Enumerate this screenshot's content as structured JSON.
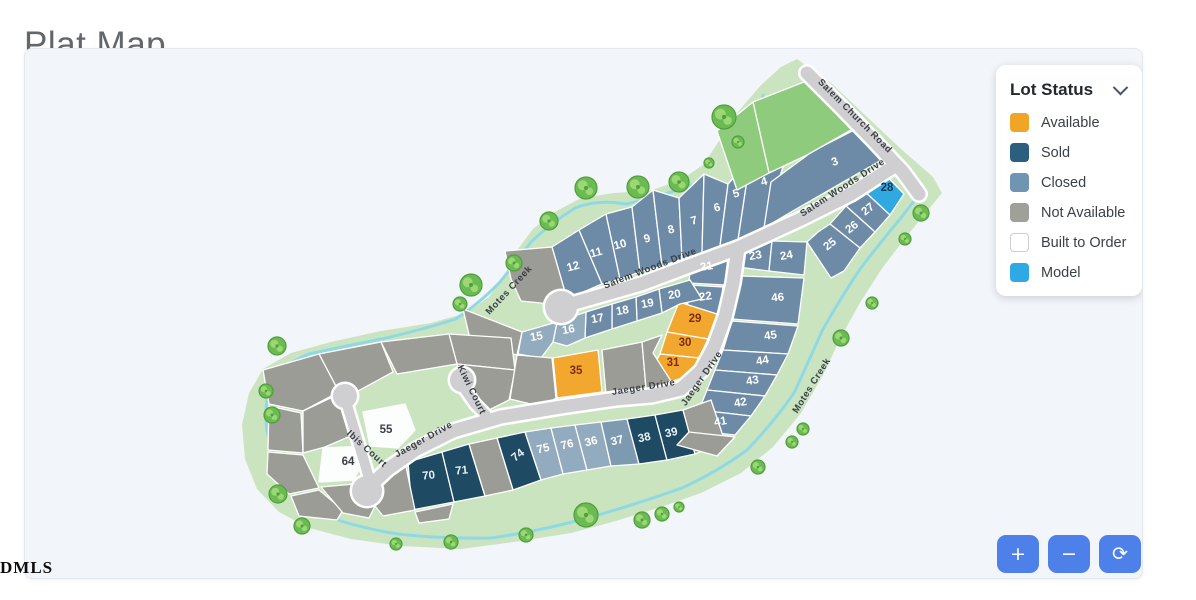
{
  "title": "Plat Map",
  "watermark": "DMLS",
  "legend": {
    "title": "Lot Status",
    "chevron_icon": "chevron-down-icon",
    "items": [
      {
        "label": "Available",
        "color": "#F0A527",
        "border": false
      },
      {
        "label": "Sold",
        "color": "#2C5F7D",
        "border": false
      },
      {
        "label": "Closed",
        "color": "#7095B3",
        "border": false
      },
      {
        "label": "Not Available",
        "color": "#9FA099",
        "border": false
      },
      {
        "label": "Built to Order",
        "color": "#FFFFFF",
        "border": true
      },
      {
        "label": "Model",
        "color": "#2FA9E4",
        "border": false
      }
    ]
  },
  "controls": [
    {
      "name": "zoom-in-button",
      "icon": "plus-icon",
      "glyph": "+"
    },
    {
      "name": "zoom-out-button",
      "icon": "minus-icon",
      "glyph": "−"
    },
    {
      "name": "reset-view-button",
      "icon": "refresh-icon",
      "glyph": "⟳"
    }
  ],
  "map": {
    "colors": {
      "buffer": "#CBE4C0",
      "creek": "#8FD9E4",
      "road": "#CFCFD1",
      "available": "#F2A72E",
      "sold": "#1E4A63",
      "closed": "#6D8BA6",
      "closed_light": "#93ABBE",
      "closed_med": "#7E9AB0",
      "na": "#9C9C96",
      "bto": "#FCFDFD",
      "model": "#2FA9E0",
      "green": "#8FCB7C",
      "tree": "#6ABB51",
      "tree_edge": "#519E3C",
      "tree_light": "#9BD774"
    },
    "text_colors": {
      "available": "#7E2D12",
      "sold": "#E8F1F7",
      "closed": "#FFFFFF",
      "closed_light": "#FFFFFF",
      "closed_med": "#FFFFFF",
      "bto": "#3A3F45",
      "model": "#16375A"
    },
    "buffer_path": "M796,58 L830,82 L864,114 L900,148 L932,176 L941,192 L928,208 L905,236 L882,266 L860,300 L840,336 L822,374 L800,412 L772,446 L740,472 L700,492 L660,506 L615,520 L570,532 L520,540 L460,548 L400,545 L350,538 L308,527 L278,511 L256,488 L244,458 L241,424 L248,392 L262,368 L290,352 L330,341 L380,330 L430,322 L465,312 L488,296 L505,272 L517,248 L532,228 L552,212 L578,198 L612,192 L648,190 L678,180 L702,164 L718,140 L736,112 L760,84 L780,66 Z",
    "creek_path": "M762,94 Q754,140 741,190 Q720,184 690,184 Q658,196 625,203 Q596,198 574,207 Q550,222 530,241 Q514,262 499,281 Q480,301 455,318 Q420,329 385,337 Q345,345 308,353 Q282,363 269,383 Q263,405 266,430 Q272,456 286,479 Q302,500 325,515 Q358,527 397,533 Q440,538 490,537 Q540,530 590,516 Q636,503 681,487 Q716,471 746,449 Q773,421 793,392 Q807,362 821,330 Q839,298 859,268 Q879,242 899,218 L913,200",
    "roads": [
      {
        "id": "salem-church-road",
        "d": "M806,72 L840,106 L872,139 L902,171 L918,193",
        "w": 13
      },
      {
        "id": "salem-woods-drive",
        "d": "M892,166 L850,193 L800,218 L737,247 L688,265 L640,283 L598,295 L570,303",
        "w": 13
      },
      {
        "id": "jaeger-drive",
        "d": "M737,247 L732,282 L724,316 L713,346 L700,370 L680,388 L650,395 L615,398 L560,406 L500,416 L452,430 L414,449 L387,468 L372,482",
        "w": 13
      },
      {
        "id": "ibis-court",
        "d": "M346,404 L355,434 L363,460 L368,477",
        "w": 10
      },
      {
        "id": "kiwi-court",
        "d": "M463,387 L474,403 L485,414",
        "w": 10
      }
    ],
    "culdesacs": [
      {
        "x": 560,
        "y": 306,
        "r": 16
      },
      {
        "x": 366,
        "y": 490,
        "r": 15
      },
      {
        "x": 344,
        "y": 395,
        "r": 12
      },
      {
        "x": 461,
        "y": 379,
        "r": 12
      }
    ],
    "road_labels": [
      {
        "text": "Salem Church Road",
        "x": 852,
        "y": 117,
        "rot": 45
      },
      {
        "text": "Salem Woods Drive",
        "x": 843,
        "y": 189,
        "rot": -33
      },
      {
        "text": "Salem Woods Drive",
        "x": 650,
        "y": 270,
        "rot": -21
      },
      {
        "text": "Jaeger Drive",
        "x": 703,
        "y": 379,
        "rot": -55
      },
      {
        "text": "Jaeger Drive",
        "x": 643,
        "y": 389,
        "rot": -9
      },
      {
        "text": "Jaeger Drive",
        "x": 424,
        "y": 441,
        "rot": -29
      },
      {
        "text": "Ibis Court",
        "x": 364,
        "y": 450,
        "rot": 42
      },
      {
        "text": "Kiwi Court",
        "x": 468,
        "y": 390,
        "rot": 64
      },
      {
        "text": "Motes Creek",
        "x": 510,
        "y": 291,
        "rot": -47
      },
      {
        "text": "Motes Creek",
        "x": 813,
        "y": 386,
        "rot": -58
      }
    ],
    "trees": [
      [
        585,
        187,
        11
      ],
      [
        637,
        186,
        11
      ],
      [
        678,
        181,
        10
      ],
      [
        723,
        116,
        12
      ],
      [
        737,
        141,
        6
      ],
      [
        708,
        162,
        5
      ],
      [
        548,
        220,
        9
      ],
      [
        513,
        262,
        8
      ],
      [
        470,
        284,
        11
      ],
      [
        459,
        303,
        7
      ],
      [
        276,
        345,
        9
      ],
      [
        265,
        390,
        7
      ],
      [
        271,
        414,
        8
      ],
      [
        277,
        493,
        9
      ],
      [
        301,
        525,
        8
      ],
      [
        585,
        514,
        12
      ],
      [
        641,
        519,
        8
      ],
      [
        661,
        513,
        7
      ],
      [
        678,
        506,
        5
      ],
      [
        525,
        534,
        7
      ],
      [
        450,
        541,
        7
      ],
      [
        395,
        543,
        6
      ],
      [
        920,
        212,
        8
      ],
      [
        904,
        238,
        6
      ],
      [
        871,
        302,
        6
      ],
      [
        840,
        337,
        8
      ],
      [
        802,
        428,
        6
      ],
      [
        791,
        441,
        6
      ],
      [
        757,
        466,
        7
      ]
    ],
    "lots": [
      {
        "n": "12",
        "s": "closed",
        "p": "551,246 578,229 601,283 566,298",
        "t": [
          573,
          269
        ],
        "r": -15
      },
      {
        "n": "11",
        "s": "closed",
        "p": "578,229 605,213 619,278 601,283",
        "t": [
          596,
          255
        ],
        "r": -15
      },
      {
        "n": "10",
        "s": "closed",
        "p": "605,213 631,206 639,271 619,278",
        "t": [
          620,
          247
        ],
        "r": -15
      },
      {
        "n": "9",
        "s": "closed",
        "p": "631,206 652,189 661,265 639,271",
        "t": [
          647,
          241
        ],
        "r": -15
      },
      {
        "n": "8",
        "s": "closed",
        "p": "652,189 678,197 681,258 661,265",
        "t": [
          671,
          232
        ],
        "r": -15
      },
      {
        "n": "7",
        "s": "closed",
        "p": "678,197 703,173 701,252 681,258",
        "t": [
          694,
          223
        ],
        "r": -15
      },
      {
        "n": "6",
        "s": "closed",
        "p": "703,173 727,183 719,245 701,252",
        "t": [
          717,
          210
        ],
        "r": -15
      },
      {
        "n": "5",
        "s": "closed",
        "p": "727,183 749,159 737,239 719,245",
        "t": [
          736,
          196
        ],
        "r": -15
      },
      {
        "n": "4",
        "s": "closed",
        "p": "749,159 789,143 763,227 737,239",
        "t": [
          764,
          184
        ],
        "r": -15
      },
      {
        "n": "3",
        "s": "closed",
        "p": "763,227 790,211 884,157 857,127 812,150 770,181",
        "t": [
          835,
          164
        ],
        "r": -20
      },
      {
        "n": "",
        "s": "green",
        "p": "808,79 857,125 806,154 768,172 752,101"
      },
      {
        "n": "",
        "s": "green",
        "p": "752,101 768,172 736,189 716,130"
      },
      {
        "n": "28",
        "s": "model",
        "p": "876,165 903,193 889,214 861,188",
        "t": [
          886,
          190
        ]
      },
      {
        "n": "27",
        "s": "closed",
        "p": "861,188 889,214 874,231 845,205",
        "t": [
          869,
          211
        ],
        "r": -38
      },
      {
        "n": "26",
        "s": "closed",
        "p": "845,205 874,231 859,247 829,223",
        "t": [
          853,
          229
        ],
        "r": -38
      },
      {
        "n": "25",
        "s": "closed",
        "p": "829,223 859,247 843,270 830,277 806,241 817,231",
        "t": [
          831,
          246
        ],
        "r": -38
      },
      {
        "n": "21",
        "s": "closed",
        "p": "690,256 728,246 724,284 688,282",
        "t": [
          706,
          269
        ],
        "r": -8
      },
      {
        "n": "22",
        "s": "closed",
        "p": "688,284 722,286 718,314 686,312",
        "t": [
          705,
          299
        ],
        "r": -8
      },
      {
        "n": "23",
        "s": "closed",
        "p": "741,243 771,240 768,270 737,266",
        "t": [
          755,
          258
        ],
        "r": -10
      },
      {
        "n": "24",
        "s": "closed",
        "p": "771,240 806,241 803,274 768,270",
        "t": [
          786,
          258
        ],
        "r": -10
      },
      {
        "n": "46",
        "s": "closed",
        "p": "739,275 803,277 797,323 731,318",
        "t": [
          777,
          300
        ],
        "r": -5
      },
      {
        "n": "45",
        "s": "closed",
        "p": "731,320 797,325 787,353 722,349",
        "t": [
          770,
          338
        ],
        "r": -8
      },
      {
        "n": "44",
        "s": "closed",
        "p": "722,349 787,353 776,374 714,369",
        "t": [
          762,
          363
        ],
        "r": -10
      },
      {
        "n": "43",
        "s": "closed",
        "p": "714,369 776,374 764,395 706,389",
        "t": [
          752,
          383
        ],
        "r": -10
      },
      {
        "n": "42",
        "s": "closed",
        "p": "706,389 764,395 750,415 698,409",
        "t": [
          740,
          405
        ],
        "r": -10
      },
      {
        "n": "41",
        "s": "closed",
        "p": "698,409 750,415 734,434 688,429",
        "t": [
          720,
          424
        ],
        "r": -10
      },
      {
        "n": "29",
        "s": "available",
        "p": "678,301 716,313 707,338 666,331",
        "t": [
          694,
          321
        ]
      },
      {
        "n": "30",
        "s": "available",
        "p": "666,331 707,338 698,357 659,353",
        "t": [
          684,
          345
        ]
      },
      {
        "n": "31",
        "s": "available",
        "p": "659,353 698,357 689,375 668,381 649,371",
        "t": [
          672,
          365
        ]
      },
      {
        "n": "20",
        "s": "closed",
        "p": "658,288 689,279 701,298 679,303 661,312",
        "t": [
          674,
          297
        ],
        "r": -10
      },
      {
        "n": "19",
        "s": "closed",
        "p": "635,296 658,288 661,312 636,320",
        "t": [
          647,
          306
        ],
        "r": -10
      },
      {
        "n": "18",
        "s": "closed",
        "p": "611,303 635,296 636,320 611,328",
        "t": [
          622,
          313
        ],
        "r": -10
      },
      {
        "n": "17",
        "s": "closed",
        "p": "585,311 611,303 611,328 584,337",
        "t": [
          597,
          321
        ],
        "r": -10
      },
      {
        "n": "16",
        "s": "closed_light",
        "p": "556,321 585,311 584,337 566,345 552,341",
        "t": [
          568,
          332
        ],
        "r": -10
      },
      {
        "n": "15",
        "s": "closed_light",
        "p": "521,331 556,321 552,341 540,357 517,353",
        "t": [
          536,
          339
        ],
        "r": -10
      },
      {
        "n": "35",
        "s": "available",
        "p": "552,357 597,349 601,391 556,397",
        "t": [
          575,
          373
        ]
      },
      {
        "n": "55",
        "s": "bto",
        "p": "362,411 404,403 414,429 397,447 369,445",
        "t": [
          385,
          432
        ]
      },
      {
        "n": "64",
        "s": "bto",
        "p": "322,447 369,445 353,479 318,481",
        "t": [
          347,
          464
        ]
      },
      {
        "n": "70",
        "s": "sold",
        "p": "407,461 441,451 453,501 411,509",
        "t": [
          428,
          478
        ],
        "r": -6
      },
      {
        "n": "71",
        "s": "sold",
        "p": "441,451 468,443 484,495 453,501",
        "t": [
          461,
          473
        ],
        "r": -6
      },
      {
        "n": "74",
        "s": "sold",
        "p": "496,437 524,431 540,479 512,489",
        "t": [
          519,
          457
        ],
        "r": -38
      },
      {
        "n": "75",
        "s": "closed_light",
        "p": "524,431 550,427 562,473 540,479",
        "t": [
          543,
          451
        ],
        "r": -14
      },
      {
        "n": "76",
        "s": "closed_light",
        "p": "550,427 574,424 586,469 562,473",
        "t": [
          567,
          447
        ],
        "r": -14
      },
      {
        "n": "36",
        "s": "closed_light",
        "p": "574,424 600,421 610,465 586,469",
        "t": [
          591,
          444
        ],
        "r": -14
      },
      {
        "n": "37",
        "s": "closed_med",
        "p": "600,421 626,418 638,463 610,465",
        "t": [
          617,
          443
        ],
        "r": -14
      },
      {
        "n": "38",
        "s": "sold",
        "p": "626,418 654,414 666,459 638,463",
        "t": [
          644,
          440
        ],
        "r": -12
      },
      {
        "n": "39",
        "s": "sold",
        "p": "654,414 682,409 694,453 666,459",
        "t": [
          671,
          435
        ],
        "r": -12
      },
      {
        "n": "",
        "s": "na",
        "p": "504,250 551,246 566,298 558,306 540,302 520,300 510,278"
      },
      {
        "n": "",
        "s": "na",
        "p": "462,308 521,331 516,354 470,342"
      },
      {
        "n": "",
        "s": "na",
        "p": "448,333 510,337 514,369 456,363"
      },
      {
        "n": "",
        "s": "na",
        "p": "456,363 514,369 508,399 488,409 472,398 459,381"
      },
      {
        "n": "",
        "s": "na",
        "p": "516,354 551,357 555,397 542,406 509,398"
      },
      {
        "n": "",
        "s": "na",
        "p": "601,349 641,341 645,387 605,393"
      },
      {
        "n": "",
        "s": "na",
        "p": "641,341 661,334 652,352 670,380 648,392 645,387"
      },
      {
        "n": "",
        "s": "na",
        "p": "380,341 448,333 456,363 396,373"
      },
      {
        "n": "",
        "s": "na",
        "p": "318,353 380,341 392,371 346,396 338,391"
      },
      {
        "n": "",
        "s": "na",
        "p": "262,369 318,353 338,391 302,410 268,403"
      },
      {
        "n": "",
        "s": "na",
        "p": "268,405 300,412 302,452 267,449"
      },
      {
        "n": "",
        "s": "na",
        "p": "267,451 302,454 318,487 288,493 266,473"
      },
      {
        "n": "",
        "s": "na",
        "p": "290,495 318,489 342,509 336,519 298,515"
      },
      {
        "n": "",
        "s": "na",
        "p": "320,486 354,483 374,505 368,517 342,512"
      },
      {
        "n": "",
        "s": "na",
        "p": "374,470 404,461 414,509 382,515 370,500"
      },
      {
        "n": "",
        "s": "na",
        "p": "414,511 452,503 448,518 418,522"
      },
      {
        "n": "",
        "s": "na",
        "p": "468,443 496,437 512,489 484,495"
      },
      {
        "n": "",
        "s": "na",
        "p": "682,409 710,399 724,441 694,453"
      },
      {
        "n": "",
        "s": "na",
        "p": "688,431 734,436 716,455 676,444"
      },
      {
        "n": "",
        "s": "na",
        "p": "302,410 340,392 346,402 352,434 324,446 302,452"
      }
    ]
  }
}
